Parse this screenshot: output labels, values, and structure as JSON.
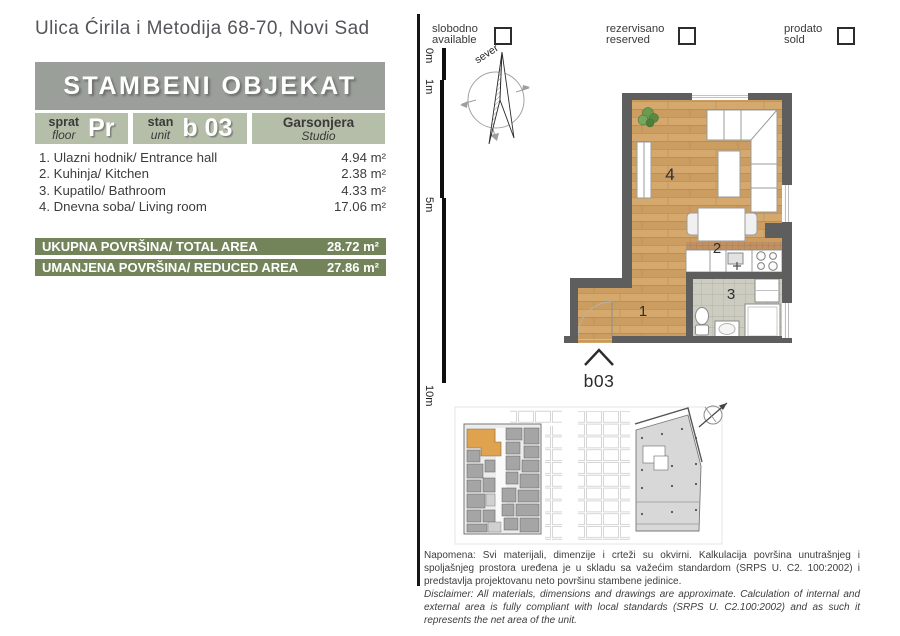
{
  "page": {
    "address": "Ulica Ćirila i Metodija 68-70, Novi Sad"
  },
  "header": {
    "title": "STAMBENI OBJEKAT"
  },
  "unit": {
    "floor": {
      "sr": "sprat",
      "en": "floor",
      "value": "Pr"
    },
    "number": {
      "sr": "stan",
      "en": "unit",
      "value": "b 03"
    },
    "type": {
      "sr": "Garsonjera",
      "en": "Studio"
    }
  },
  "rooms": [
    {
      "label": "1. Ulazni hodnik/ Entrance hall",
      "area": "4.94 m²"
    },
    {
      "label": "2. Kuhinja/ Kitchen",
      "area": "2.38 m²"
    },
    {
      "label": "3. Kupatilo/ Bathroom",
      "area": "4.33 m²"
    },
    {
      "label": "4. Dnevna soba/ Living room",
      "area": "17.06 m²"
    }
  ],
  "totals": [
    {
      "label": "UKUPNA POVRŠINA/ TOTAL AREA",
      "value": "28.72 m²"
    },
    {
      "label": "UMANJENA POVRŠINA/ REDUCED AREA",
      "value": "27.86 m²"
    }
  ],
  "legend": [
    {
      "sr": "slobodno",
      "en": "available"
    },
    {
      "sr": "rezervisano",
      "en": "reserved"
    },
    {
      "sr": "prodato",
      "en": "sold"
    }
  ],
  "compass": {
    "north": "sever"
  },
  "scalebar": {
    "marks": [
      "0m",
      "1m",
      "5m",
      "10m"
    ]
  },
  "floorplan": {
    "unit_label": "b03",
    "room_numbers": {
      "hall": "1",
      "kitchen": "2",
      "bathroom": "3",
      "living": "4"
    }
  },
  "disclaimer": {
    "sr": "Napomena: Svi materijali, dimenzije i crteži su okvirni. Kalkulacija površina unutrašnjeg i spoljašnjeg prostora uređena je u skladu sa važećim standardom (SRPS U. C2. 100:2002) i predstavlja projektovanu neto površinu stambene jedinice.",
    "en": "Disclaimer: All materials, dimensions and drawings are approximate. Calculation of internal and external area is fully compliant with local standards (SRPS U. C2.100:2002) and as such it represents the net area of the unit."
  },
  "colors": {
    "accent_green": "#73845b",
    "box_green": "#b5bea9",
    "header_gray": "#9b9f99",
    "wall_gray": "#5e5e5e",
    "wood": "#d3a76b",
    "highlight_orange": "#dfa24f"
  }
}
